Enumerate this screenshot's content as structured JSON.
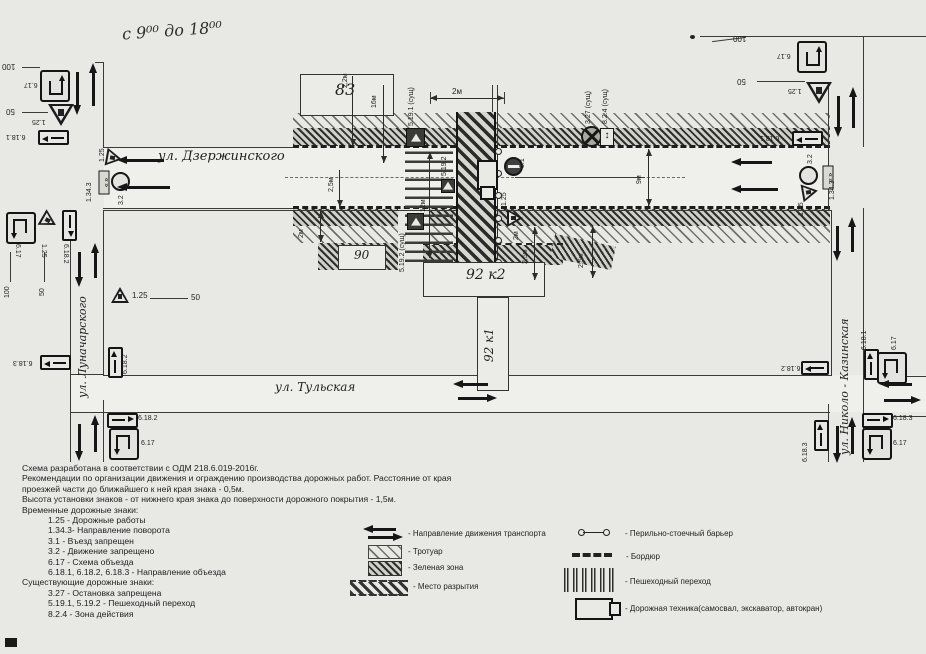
{
  "annotation": {
    "hours": "с 9⁰⁰ до 18⁰⁰"
  },
  "streets": {
    "dzerzhinskogo": "ул. Дзержинского",
    "tulskaya": "ул. Тульская",
    "lunacharskogo": "ул. Луначарского",
    "nikolo_kazinskaya": "ул. Николо - Казинская"
  },
  "buildings": {
    "b83": "83",
    "b90": "90",
    "b92k2": "92 к2",
    "b92k1": "92 к1"
  },
  "signs": {
    "s617": "6.17",
    "s125": "1.25",
    "s6181": "6.18.1",
    "s6182": "6.18.2",
    "s6183": "6.18.3",
    "s32": "3.2",
    "s31": "3.1",
    "s1343": "1.34.3",
    "s5191": "5.19.1 (сущ)",
    "s5192": "5.19.2",
    "s5192s": "5.19.2 (сущ)",
    "s327": "3.27 (сущ)",
    "s824": "8.2.4 (сущ)"
  },
  "dims": {
    "d100": "100",
    "d50": "50",
    "d22": "2,2м",
    "d16": "16м",
    "d2": "2м",
    "d25": "2,5м",
    "d12": "12м",
    "d9": "9м"
  },
  "notes": {
    "lines": [
      "Схема разработана в соответствии с ОДМ 218.6.019-2016г.",
      "Рекомендации по организации движения и ограждению производства дорожных работ. Расстояние от края",
      "проезжей части до ближайшего к ней края знака - 0,5м.",
      "Высота установки знаков - от нижнего края знака до поверхности дорожного покрытия - 1,5м.",
      "Временные дорожные знаки:",
      "1.25 - Дорожные работы",
      "1.34.3- Направление поворота",
      "3.1 - Въезд запрещен",
      "3.2 - Движение запрещено",
      "6.17 - Схема объезда",
      "6.18.1, 6.18.2, 6.18.3 - Направление объезда",
      "Существующие дорожные знаки:",
      "3.27 - Остановка запрещена",
      "5.19.1, 5.19.2 - Пешеходный переход",
      "8.2.4 - Зона действия"
    ]
  },
  "legend": {
    "left": [
      {
        "name": "traffic-direction",
        "label": "- Направление движения транспорта"
      },
      {
        "name": "sidewalk",
        "label": "- Тротуар"
      },
      {
        "name": "green-zone",
        "label": "- Зеленая зона"
      },
      {
        "name": "excavation",
        "label": "- Место разрытия"
      }
    ],
    "right": [
      {
        "name": "post-barrier",
        "label": "- Перильно-стоечный барьер"
      },
      {
        "name": "curb",
        "label": "- Бордюр"
      },
      {
        "name": "crosswalk",
        "label": "- Пешеходный переход"
      },
      {
        "name": "machinery",
        "label": "- Дорожная техника(самосвал, экскаватор, автокран)"
      }
    ]
  },
  "colors": {
    "paper": "#e8e8e5",
    "ink": "#1f1f1f"
  }
}
